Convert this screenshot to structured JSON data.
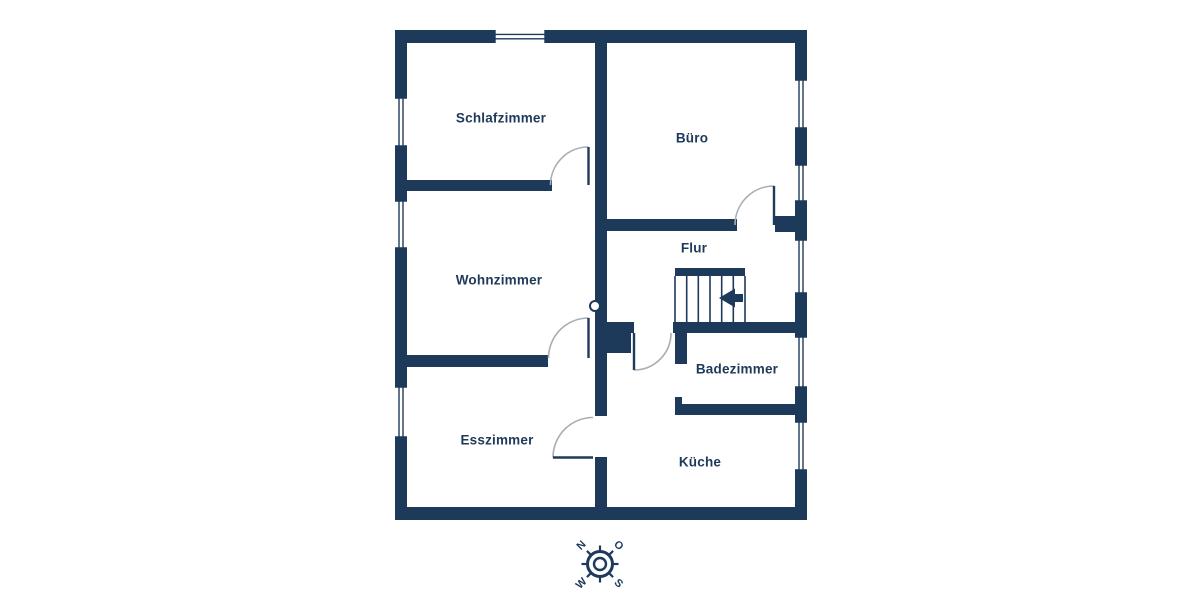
{
  "floorplan": {
    "rooms": [
      {
        "label": "Schlafzimmer"
      },
      {
        "label": "Büro"
      },
      {
        "label": "Wohnzimmer"
      },
      {
        "label": "Flur"
      },
      {
        "label": "Badezimmer"
      },
      {
        "label": "Esszimmer"
      },
      {
        "label": "Küche"
      }
    ],
    "stairs": {
      "arrow_direction": "left"
    },
    "compass": {
      "north": "N",
      "east": "O",
      "south": "S",
      "west": "W"
    },
    "colors": {
      "wall": "#1e3a5b",
      "door_arc": "#a7adb3",
      "background": "#ffffff"
    }
  }
}
